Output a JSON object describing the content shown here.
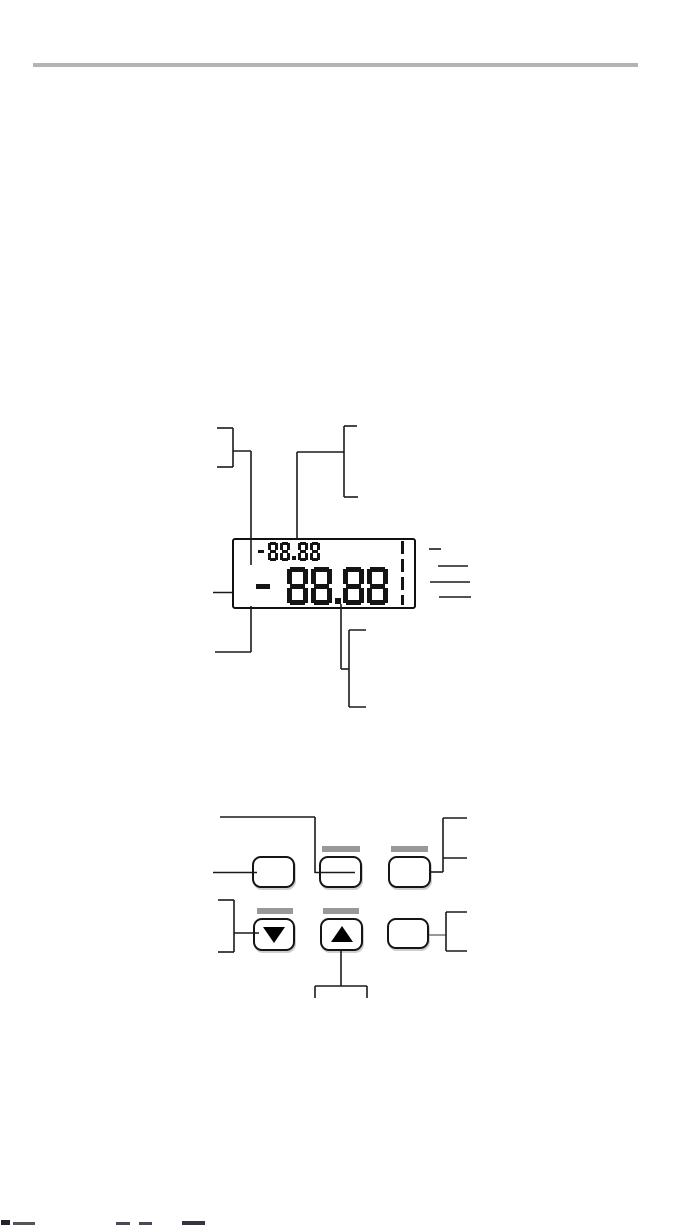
{
  "page": {
    "background": "#ffffff",
    "top_rule_color": "#b3b3b3"
  },
  "lcd_figure": {
    "small_display_value": "-88.88",
    "main_display_value": "-88.88",
    "segment_color": "#141414",
    "level_bar_icon": "dashed-vertical-level-bar",
    "right_callout_count": 4
  },
  "keypad_figure": {
    "led_bar_color": "#999999",
    "buttons": [
      {
        "name": "button-top-left",
        "icon": null,
        "led_bar": false
      },
      {
        "name": "button-top-middle",
        "icon": null,
        "led_bar": true
      },
      {
        "name": "button-top-right",
        "icon": null,
        "led_bar": true
      },
      {
        "name": "button-down",
        "icon": "down-arrow-icon",
        "led_bar": true
      },
      {
        "name": "button-up",
        "icon": "up-arrow-icon",
        "led_bar": true
      },
      {
        "name": "button-bottom-right",
        "icon": null,
        "led_bar": false
      }
    ]
  },
  "footer": {
    "clipped_text_sliver": true
  }
}
